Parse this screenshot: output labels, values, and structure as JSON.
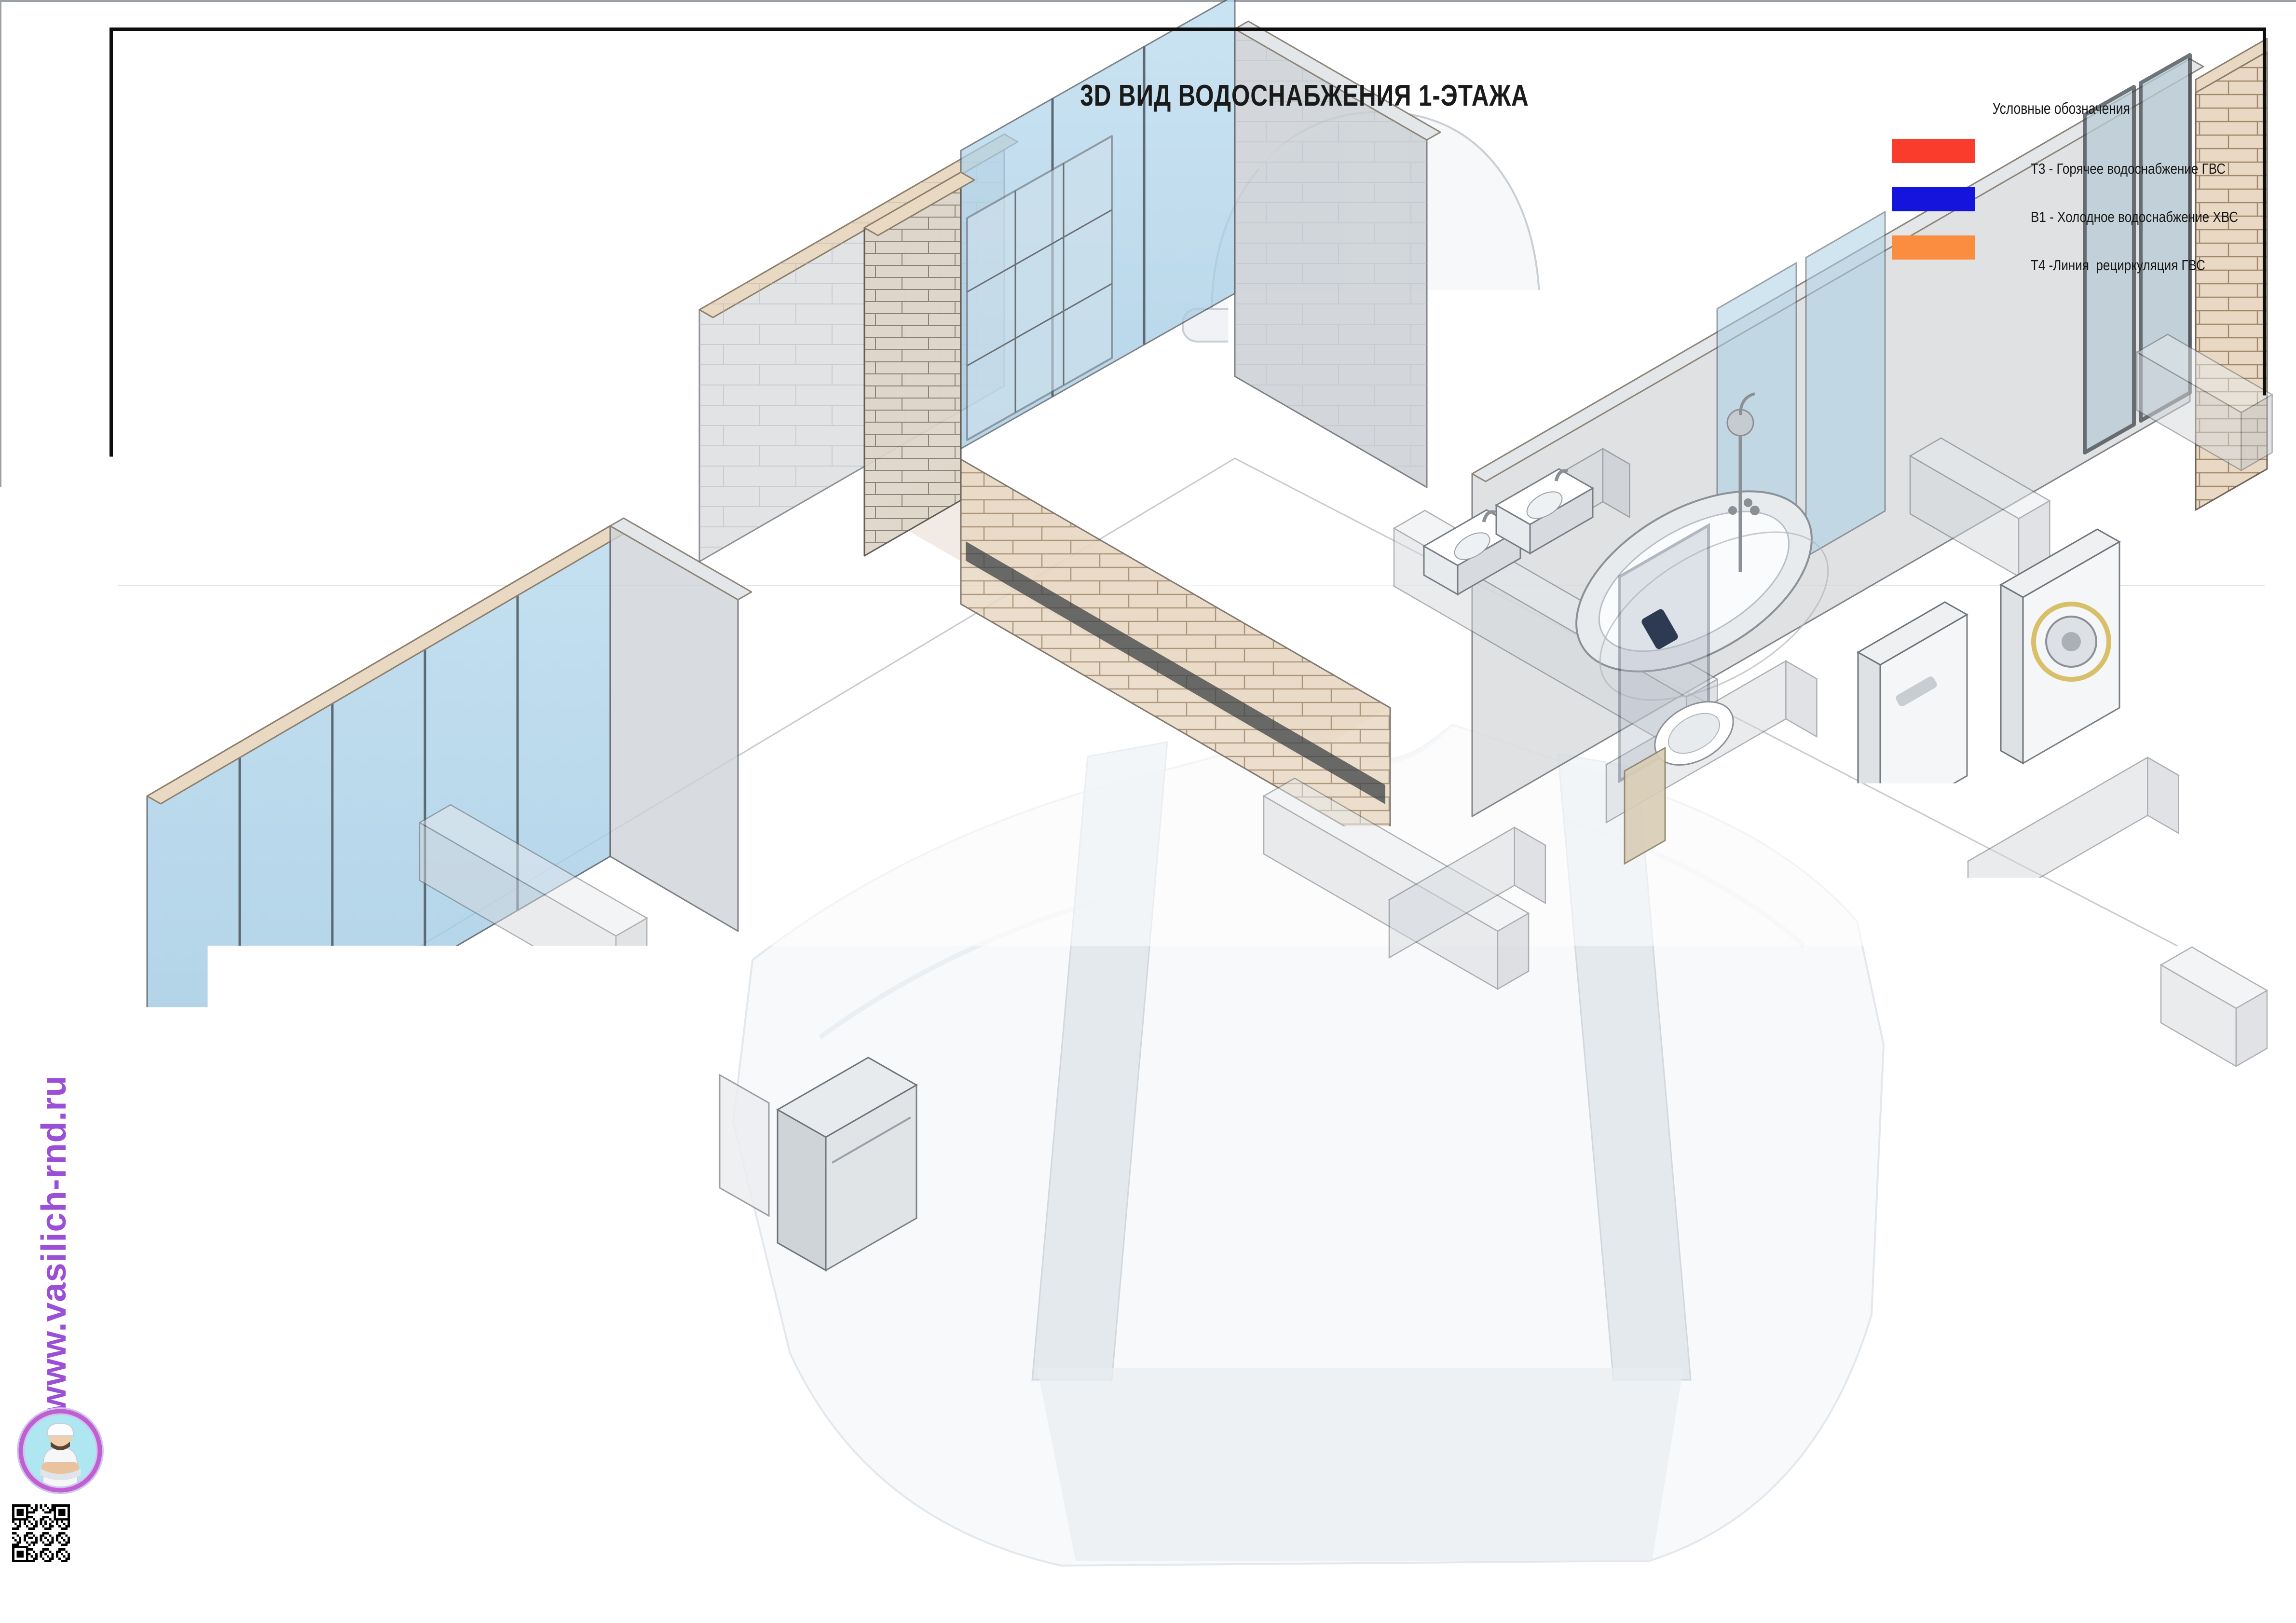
{
  "sheet": {
    "title": "3D ВИД ВОДОСНАБЖЕНИЯ 1-ЭТАЖА"
  },
  "legend": {
    "header": "Условные обозначения",
    "items": [
      {
        "label": "Т3 - Горячее водоснабжение ГВС",
        "color": "#fa3c2d",
        "system": "hot-water"
      },
      {
        "label": "В1 - Холодное водоснабжение ХВС",
        "color": "#1414dc",
        "system": "cold-water"
      },
      {
        "label": "Т4 -Линия  рециркуляция ГВС",
        "color": "#fb8d41",
        "system": "recirculation"
      }
    ]
  },
  "watermark": {
    "website": "www.vasilich-rnd.ru",
    "brand_purple": "#9a4fd6"
  },
  "titleblock": {
    "labels": {
      "izm": "Изм.",
      "list": "Лист",
      "doc": "№ док.",
      "sign": "Подпись",
      "date": "Дата"
    },
    "sheet_word": "Лист",
    "sheet_number": "4.3",
    "copied": "Копировал",
    "format": "Формат"
  }
}
